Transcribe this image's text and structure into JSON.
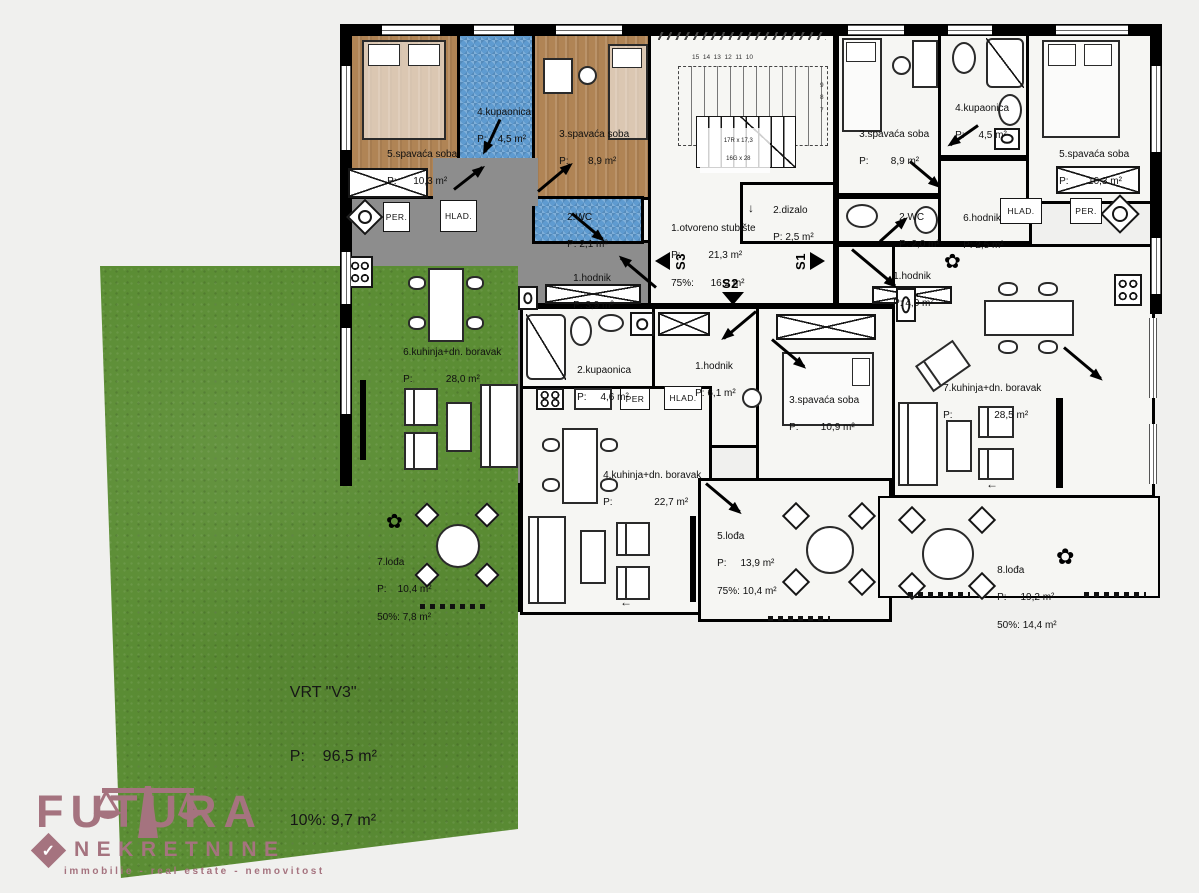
{
  "colors": {
    "wall": "#000000",
    "floor": "#f6f6f3",
    "bedroom_wood": "#b08455",
    "bath_tile": "#5f9bd0",
    "living_gray": "#8d8d8d",
    "terrace_gray": "#9ba1a8",
    "garden_green": "#5b8d34",
    "logo_accent": "#a5737f",
    "background": "#f0f0ee"
  },
  "rooms": {
    "a1_bed5": {
      "name": "5.spavaća soba",
      "area": "P:      10,3 m²"
    },
    "a1_bath4": {
      "name": "4.kupaonica",
      "area": "P:    4,5 m²"
    },
    "a1_bed3": {
      "name": "3.spavaća soba",
      "area": "P:       8,9 m²"
    },
    "a1_wc2": {
      "name": "2.WC",
      "area": "P: 2,1 m²"
    },
    "a1_hall1": {
      "name": "1.hodnik",
      "area": "P: 3,9 m²"
    },
    "a1_living6": {
      "name": "6.kuhinja+dn. boravak",
      "area": "P:            28,0 m²"
    },
    "a1_loggia7": {
      "name": "7.lođa",
      "area": "P:    10,4 m²",
      "extra": "50%: 7,8 m²"
    },
    "stair1": {
      "name": "1.otvoreno stubište",
      "area": "P:          21,3 m²",
      "extra": "75%:      16,2 m²"
    },
    "lift2": {
      "name": "2.dizalo",
      "area": "P: 2,5 m²"
    },
    "a2_bath2": {
      "name": "2.kupaonica",
      "area": "P:     4,6 m²"
    },
    "a2_hall1": {
      "name": "1.hodnik",
      "area": "P: 6,1 m²"
    },
    "a2_bed3": {
      "name": "3.spavaća soba",
      "area": "P:        10,9 m²"
    },
    "a2_living4": {
      "name": "4.kuhinja+dn. boravak",
      "area": "P:               22,7 m²"
    },
    "a2_loggia5": {
      "name": "5.lođa",
      "area": "P:     13,9 m²",
      "extra": "75%: 10,4 m²"
    },
    "a3_bed3": {
      "name": "3.spavaća soba",
      "area": "P:        8,9 m²"
    },
    "a3_wc2": {
      "name": "2.WC",
      "area": "P: 2,0 m²"
    },
    "a3_hall1": {
      "name": "1.hodnik",
      "area": "P: 4,0 m²"
    },
    "a3_bath4": {
      "name": "4.kupaonica",
      "area": "P:     4,5 m²"
    },
    "a3_hall6": {
      "name": "6.hodnik",
      "area": "P: 2,5 m²"
    },
    "a3_bed5": {
      "name": "5.spavaća soba",
      "area": "P:       10,3 m²"
    },
    "a3_living7": {
      "name": "7.kuhinja+dn. boravak",
      "area": "P:               28,5 m²"
    },
    "a3_loggia8": {
      "name": "8.lođa",
      "area": "P:     19,2 m²",
      "extra": "50%: 14,4 m²"
    }
  },
  "garden": {
    "name": "VRT \"V3\"",
    "area": "P:    96,5 m²",
    "extra": "10%: 9,7 m²"
  },
  "stairwell": {
    "s1": "S1",
    "s2": "S2",
    "s3": "S3",
    "note1": "17R x 17,3",
    "note2": "16G x 28",
    "upper_steps": "15  14  13  12  11  10",
    "side_steps": "9\n8\n7",
    "lift_arrow": "↓",
    "exit_arrow": "←"
  },
  "appliances": {
    "washer": "PER.",
    "fridge": "HLAD.",
    "washer_short": "PER"
  },
  "logo": {
    "title": "FUTURA",
    "subtitle": "NEKRETNINE",
    "tagline": "immobilie  -  real estate  -  nemovitost"
  }
}
